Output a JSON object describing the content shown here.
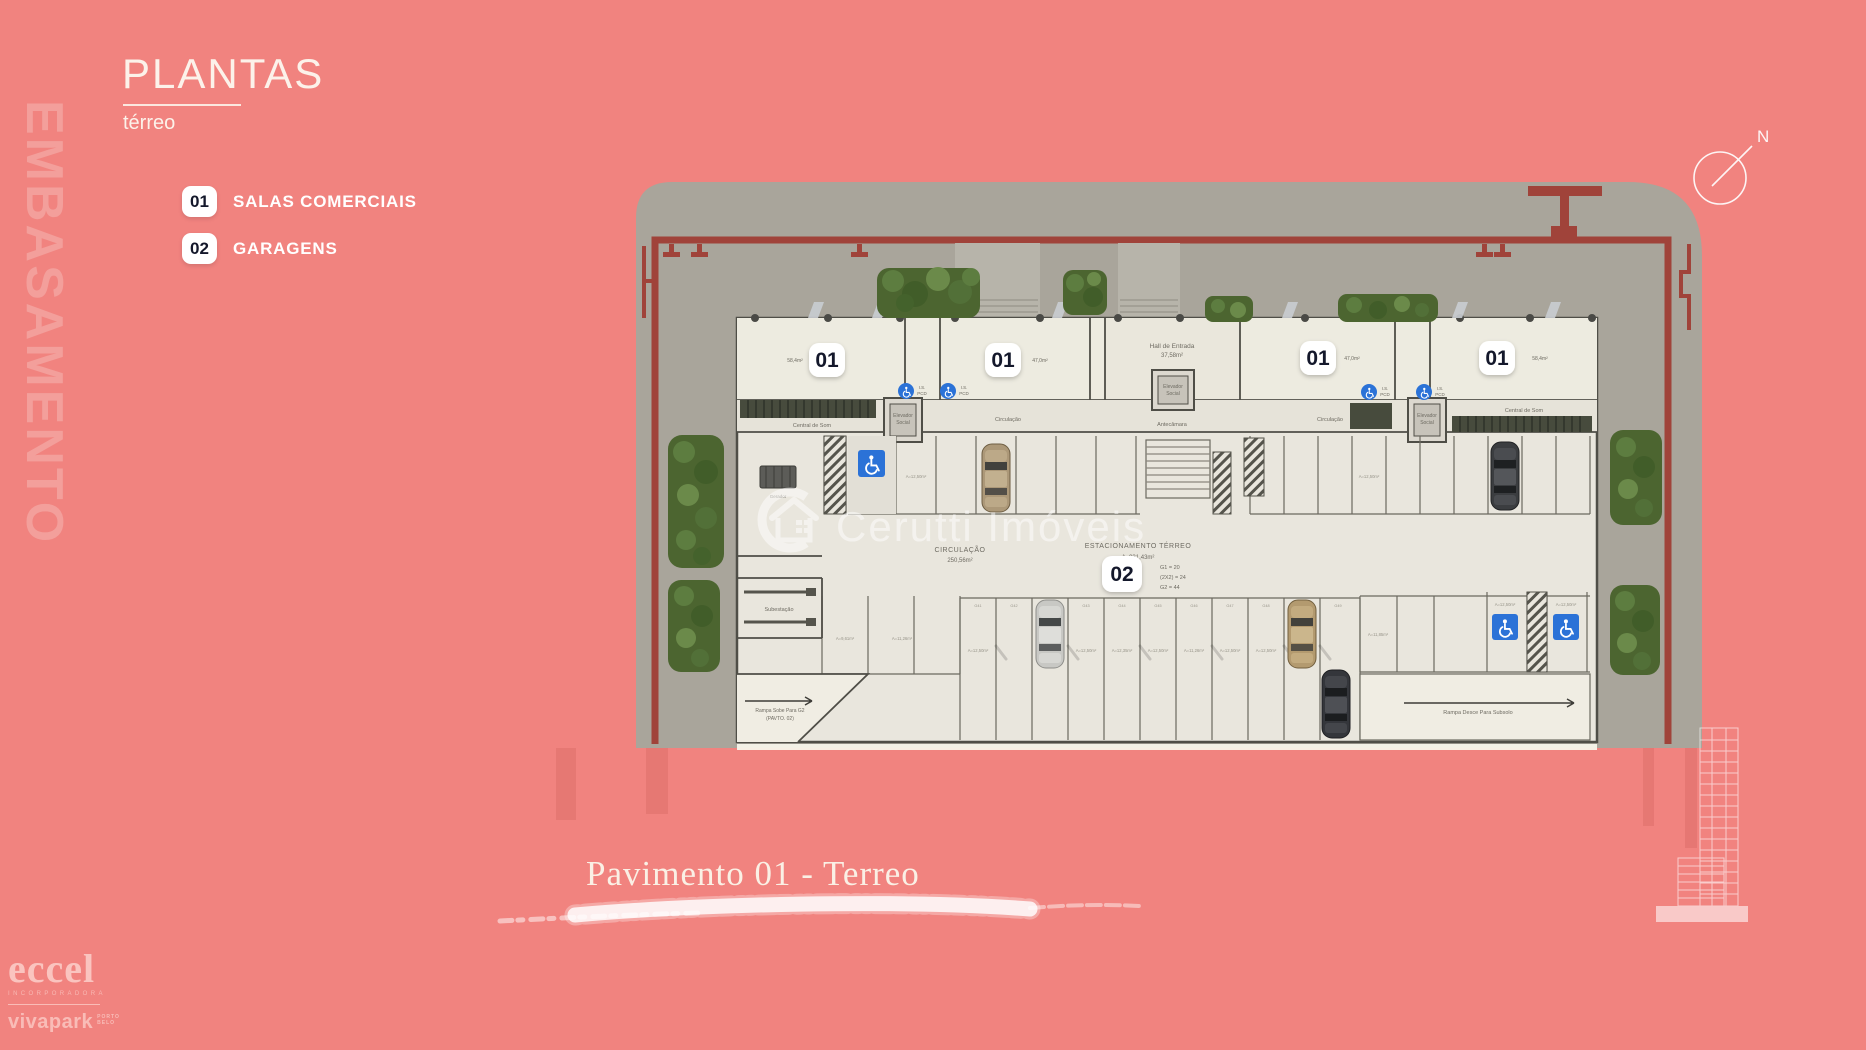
{
  "colors": {
    "background": "#F1837F",
    "plaza_gray": "#A9A59B",
    "floor_cream": "#E9E6DD",
    "boundary_maroon": "#A0433A",
    "wall_dark": "#4F4E47",
    "hedge_green": "#4C6530",
    "accessible_blue": "#2B72D7",
    "badge_background": "#FFFFFF",
    "badge_text": "#14182B",
    "cream_text": "#FCF2EA"
  },
  "side_watermark": "EMBASAMENTO",
  "header": {
    "title": "PLANTAS",
    "subtitle": "térreo"
  },
  "legend": {
    "items": [
      {
        "code": "01",
        "label": "SALAS COMERCIAIS"
      },
      {
        "code": "02",
        "label": "GARAGENS"
      }
    ]
  },
  "compass": {
    "north_label": "N"
  },
  "caption": "Pavimento 01 - Terreo",
  "branding": {
    "developer_name": "eccel",
    "developer_tagline": "INCORPORADORA",
    "project_name": "vivapark",
    "project_sub_line1": "PORTO",
    "project_sub_line2": "BELO"
  },
  "floor_plan": {
    "unit_badges": [
      "01",
      "01",
      "01",
      "01"
    ],
    "garage_badge": "02",
    "watermark_text": "Cerutti Imóveis",
    "unit_area_labels": [
      "58,4m²",
      "47,0m²",
      "47,0m²",
      "58,4m²"
    ],
    "labels": {
      "hall_line1": "Hall de Entrada",
      "hall_line2": "37,58m²",
      "elevador_line1": "Elevador",
      "elevador_line2": "Social",
      "antecamara": "Antecâmara",
      "circulacao": "Circulação",
      "central_som": "Central de Som",
      "subestacao": "Subestação",
      "gerador": "Gerador",
      "is_line1": "I.S.",
      "is_line2": "PCD",
      "circ_title": "CIRCULAÇÃO",
      "circ_area": "250,56m²",
      "estac_title": "ESTACIONAMENTO TÉRREO",
      "estac_area": "A=931,43m²",
      "count_1": "G1 = 20",
      "count_2": "(2X2) = 24",
      "count_3": "G2 = 44",
      "rampa_sobe_line1": "Rampa Sobe Para G2",
      "rampa_sobe_line2": "(PAVTO. 02)",
      "rampa_desce": "Rampa Desce Para Subsolo"
    },
    "stall_numbers": [
      "G41",
      "G42",
      "G43",
      "G44",
      "G45",
      "G46",
      "G47",
      "G48",
      "G49",
      "G50",
      "G51"
    ],
    "stall_labels": [
      "A=9,61m²",
      "A=11,26m²",
      "A=12,50m²",
      "A=12,50m²",
      "A=12,35m²",
      "A=12,50m²",
      "A=11,26m²",
      "A=12,50m²",
      "A=12,50m²",
      "A=11,85m²",
      "A=12,50m²",
      "A=12,50m²"
    ]
  }
}
